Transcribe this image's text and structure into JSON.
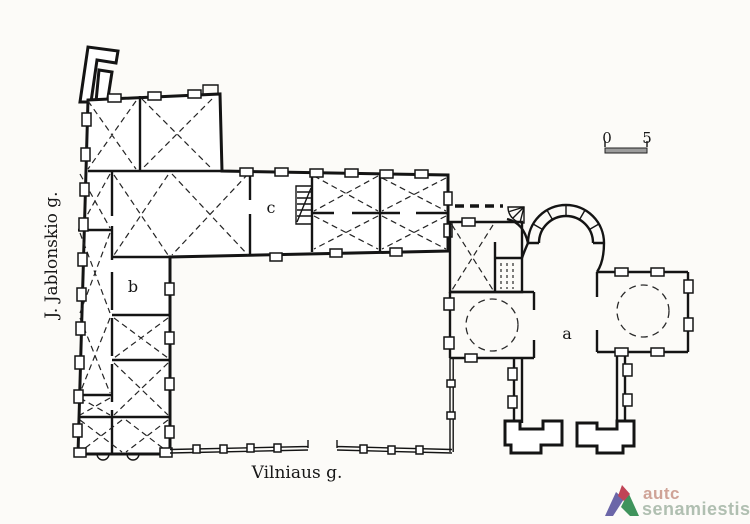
{
  "figure": {
    "kind": "scanned architectural ground-floor plan of a church and monastery ensemble in Vilnius",
    "background_color": "#fcfbf8",
    "ink_color": "#141414"
  },
  "labels": {
    "street_left": "J. Jablonskio g.",
    "street_bottom": "Vilniaus g.",
    "church": "a",
    "room_b": "b",
    "room_c": "c"
  },
  "scale_bar": {
    "zero": "0",
    "five": "5"
  },
  "watermark": {
    "line1": "autc",
    "line2": "senamiestis",
    "colors": {
      "line1": "#cfa397",
      "line2": "#b0bfb1",
      "triangle_left": "#6b66a8",
      "triangle_right": "#3f935c",
      "triangle_apex": "#c04456"
    }
  }
}
